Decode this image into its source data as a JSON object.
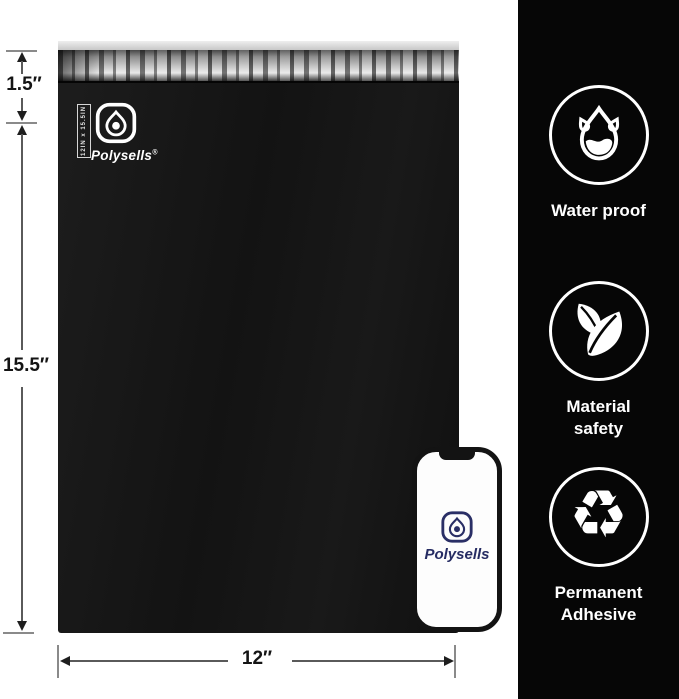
{
  "bag": {
    "brand": "Polysells",
    "registered": "®",
    "size_tag": "12IN x 15.5IN"
  },
  "dimensions": {
    "flap": "1.5″",
    "height": "15.5″",
    "width": "12″"
  },
  "features": [
    {
      "icon": "water-drop-icon",
      "label": "Water proof"
    },
    {
      "icon": "leaves-icon",
      "label": "Material safety"
    },
    {
      "icon": "recycle-icon",
      "label": "Permanent Adhesive"
    }
  ],
  "icons": {
    "recycle_glyph": "♻"
  },
  "phone": {
    "brand": "Polysells"
  },
  "colors": {
    "background": "#ffffff",
    "sidebar_bg": "#060606",
    "bag_black": "#151515",
    "adhesive_silver": "#b7b7b7",
    "brand_navy": "#2a2f66",
    "icon_white": "#ffffff"
  }
}
